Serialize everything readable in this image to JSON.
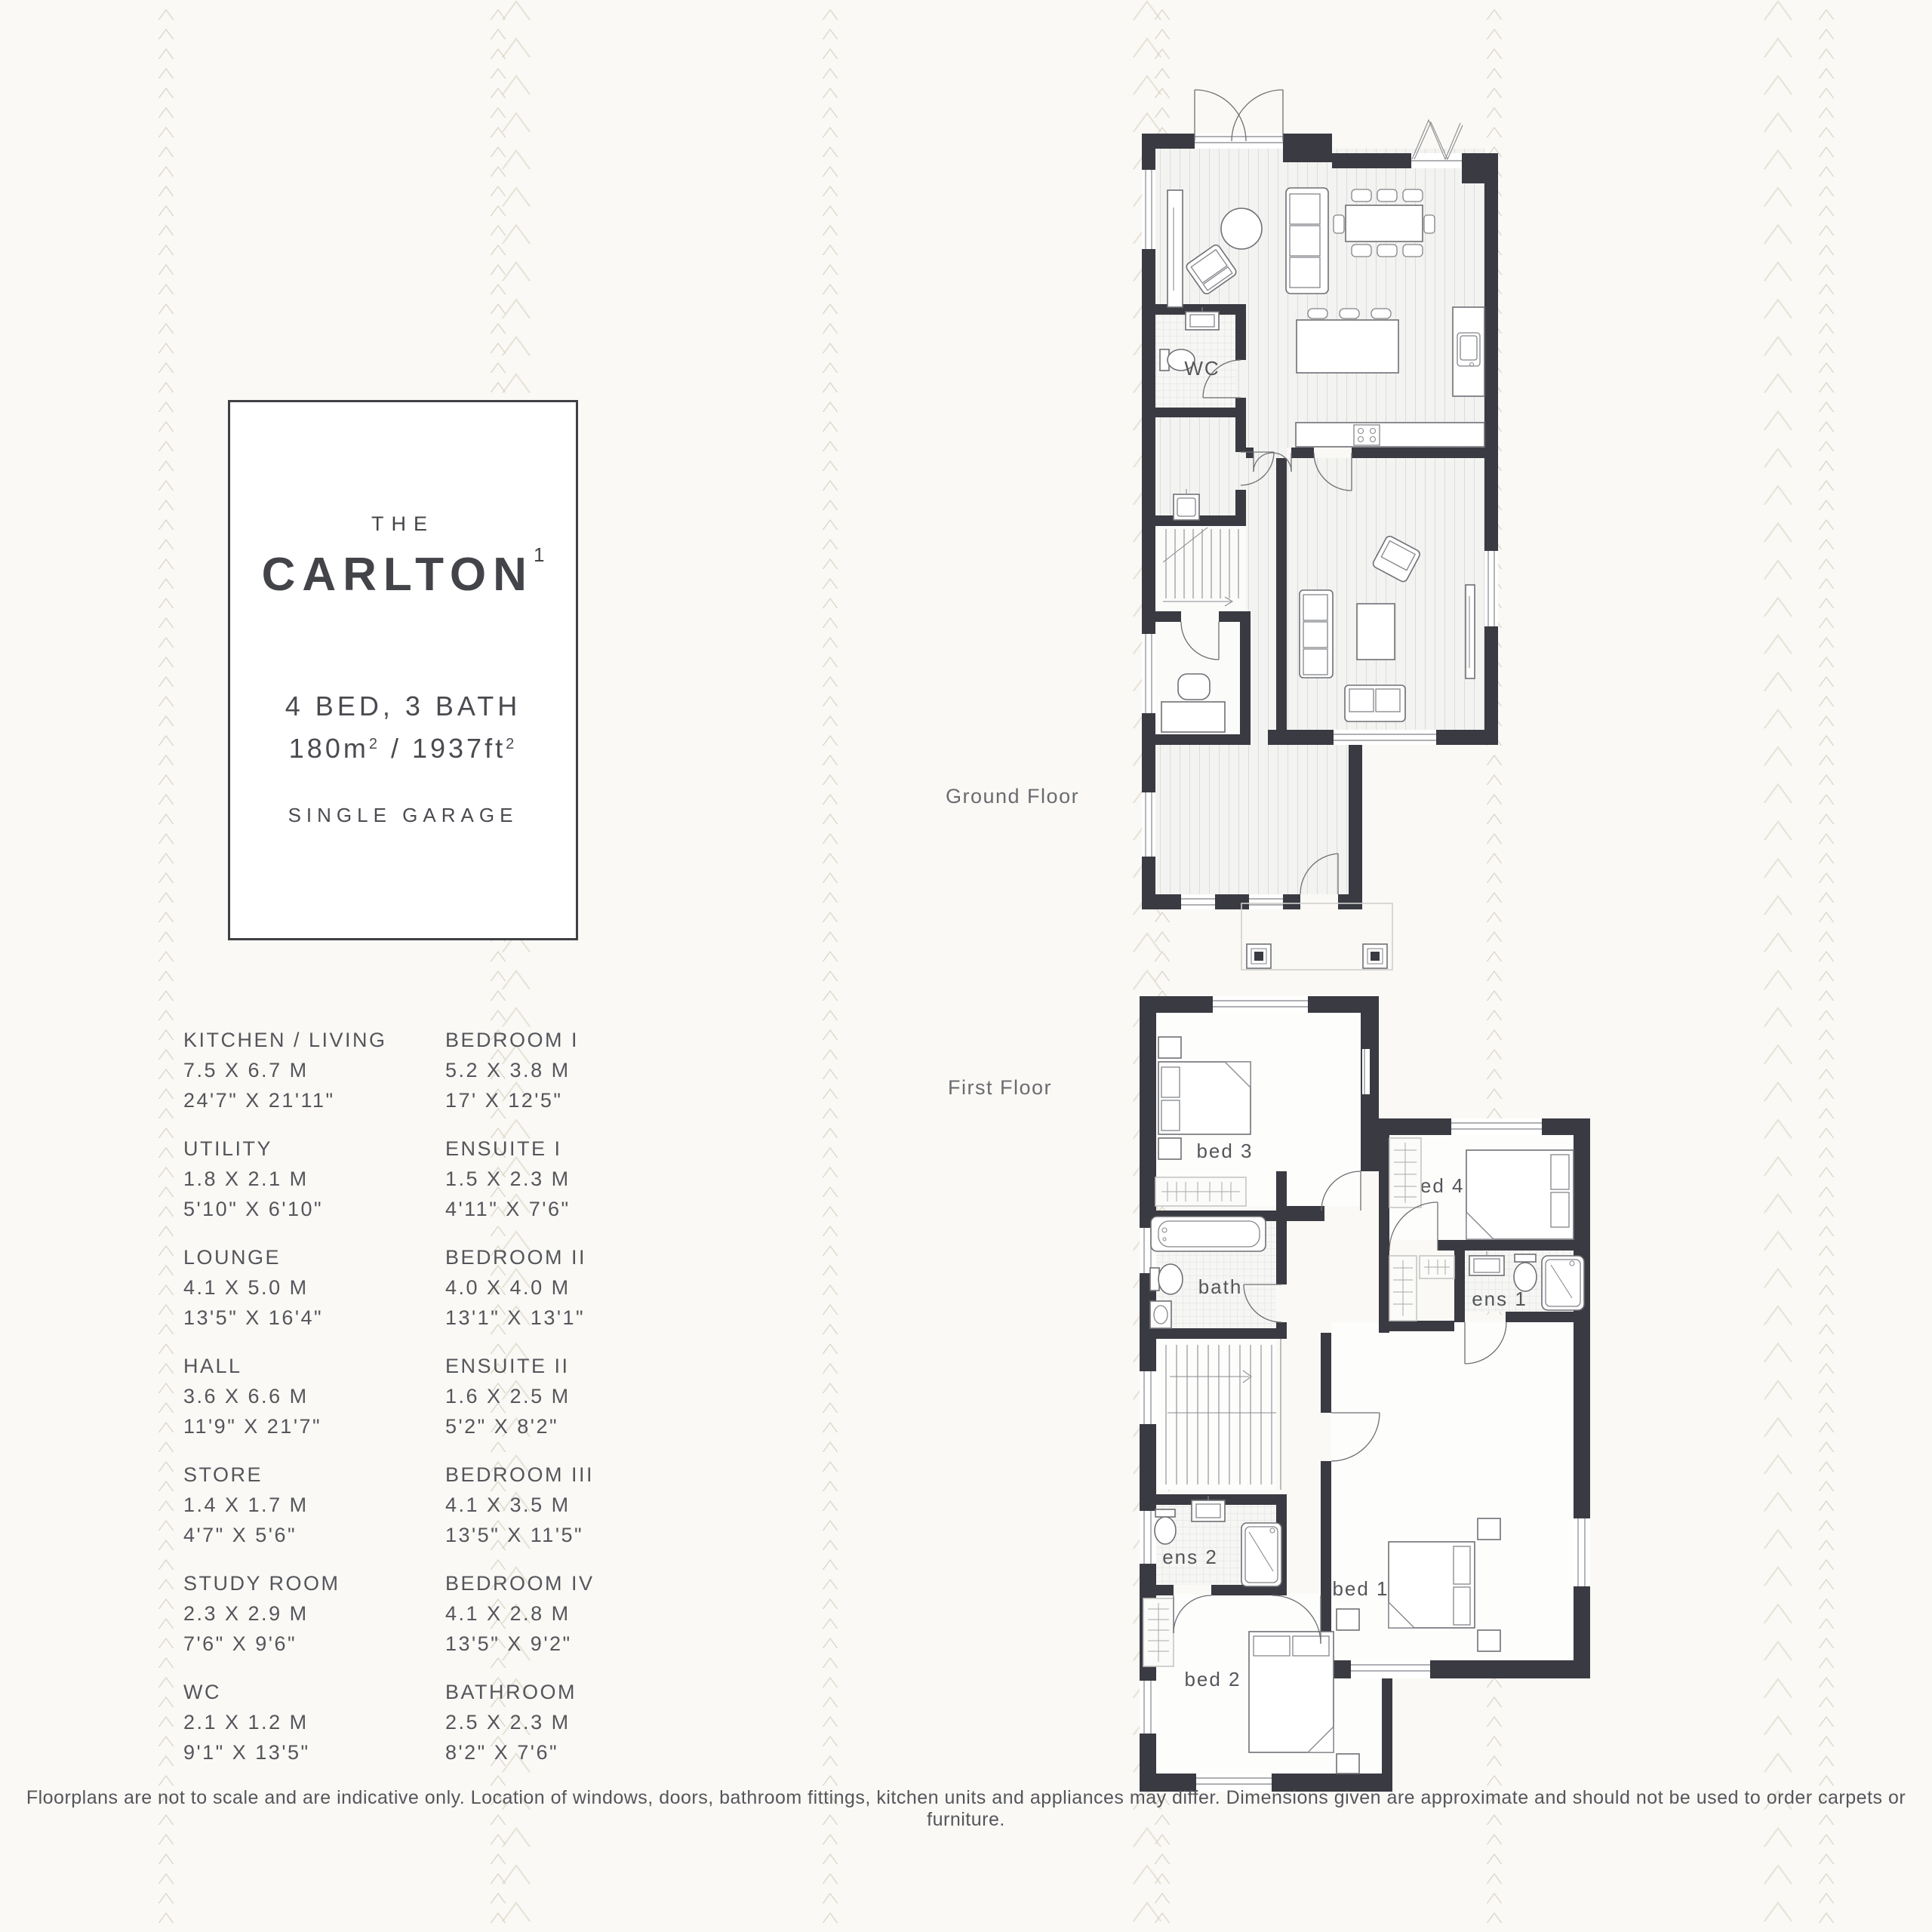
{
  "palette": {
    "background": "#faf9f5",
    "pattern_line": "#d7d1c2",
    "wall": "#3a3a42",
    "text": "#55565c",
    "title_text": "#434449",
    "floor_label_text": "#6a6b70"
  },
  "title_card": {
    "prefix": "THE",
    "name": "CARLTON",
    "superscript": "1",
    "spec": "4 BED, 3 BATH",
    "area_m": "180m",
    "area_m_sup": "2",
    "area_sep": " / ",
    "area_ft": "1937ft",
    "area_ft_sup": "2",
    "garage": "SINGLE GARAGE"
  },
  "room_list": {
    "left": [
      {
        "name": "KITCHEN / LIVING",
        "metric": "7.5 X 6.7 M",
        "imperial": "24'7\" X 21'11\""
      },
      {
        "name": "UTILITY",
        "metric": "1.8 X 2.1 M",
        "imperial": "5'10\" X 6'10\""
      },
      {
        "name": "LOUNGE",
        "metric": "4.1 X 5.0 M",
        "imperial": "13'5\" X 16'4\""
      },
      {
        "name": "HALL",
        "metric": "3.6 X 6.6 M",
        "imperial": "11'9\" X 21'7\""
      },
      {
        "name": "STORE",
        "metric": "1.4 X 1.7 M",
        "imperial": "4'7\" X 5'6\""
      },
      {
        "name": "STUDY ROOM",
        "metric": "2.3 X 2.9 M",
        "imperial": "7'6\" X 9'6\""
      },
      {
        "name": "WC",
        "metric": "2.1 X 1.2 M",
        "imperial": "9'1\" X 13'5\""
      }
    ],
    "right": [
      {
        "name": "BEDROOM I",
        "metric": "5.2 X 3.8 M",
        "imperial": "17' X 12'5\""
      },
      {
        "name": "ENSUITE I",
        "metric": "1.5 X 2.3 M",
        "imperial": "4'11\" X 7'6\""
      },
      {
        "name": "BEDROOM II",
        "metric": "4.0 X 4.0 M",
        "imperial": "13'1\" X 13'1\""
      },
      {
        "name": "ENSUITE II",
        "metric": "1.6 X 2.5 M",
        "imperial": "5'2\" X 8'2\""
      },
      {
        "name": "BEDROOM III",
        "metric": "4.1 X 3.5 M",
        "imperial": "13'5\" X 11'5\""
      },
      {
        "name": "BEDROOM IV",
        "metric": "4.1 X 2.8 M",
        "imperial": "13'5\" X 9'2\""
      },
      {
        "name": "BATHROOM",
        "metric": "2.5 X 2.3 M",
        "imperial": "8'2\" X 7'6\""
      }
    ]
  },
  "floors": {
    "ground": {
      "label": "Ground Floor",
      "rooms": {
        "wc": "WC"
      }
    },
    "first": {
      "label": "First Floor",
      "rooms": {
        "bed3": "bed 3",
        "bed4": "bed 4",
        "bath": "bath",
        "ens1": "ens 1",
        "ens2": "ens 2",
        "bed2": "bed 2",
        "bed1": "bed 1"
      }
    }
  },
  "disclaimer": "Floorplans are not to scale and are indicative only. Location of windows, doors, bathroom fittings, kitchen units and appliances may differ. Dimensions given are approximate and should not be used to order carpets or furniture."
}
